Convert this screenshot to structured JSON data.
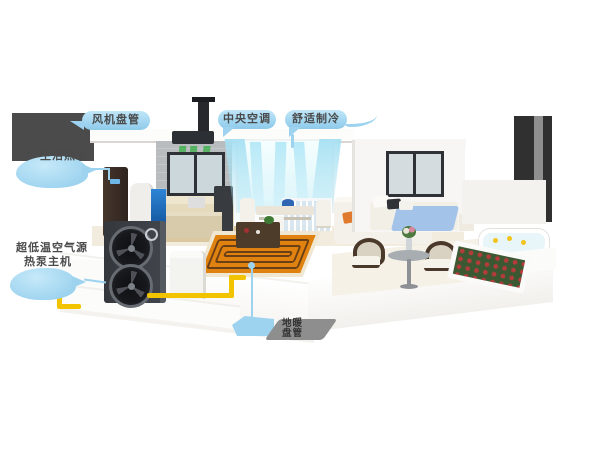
{
  "callouts": {
    "fan_coil": {
      "text": "风机盘管"
    },
    "central_ac": {
      "text": "中央空调"
    },
    "comfort_cooling": {
      "text": "舒适制冷"
    },
    "hot_water": {
      "text": "生活热水"
    },
    "heat_pump": {
      "line1": "超低温空气源",
      "line2": "热泵主机"
    },
    "floor_heating": {
      "line1": "地暖",
      "line2": "盘管"
    }
  },
  "colors": {
    "callout_bubble": "#9dd3ef",
    "callout_text": "#4a4a4a",
    "green_airflow": "#3cb04a",
    "cool_airflow": "#b0e6f6",
    "floor_heating_mat": "#e0820f",
    "floor_heating_coil": "#6b3f16",
    "water_pipe": "#f2c400",
    "outdoor_unit": "#3b3e43",
    "bed_blanket": "#a3c3e8",
    "accent_pillows": "#e07a2e",
    "flowers": "#b53b3b",
    "cut_wall": "#4b4b4b"
  }
}
